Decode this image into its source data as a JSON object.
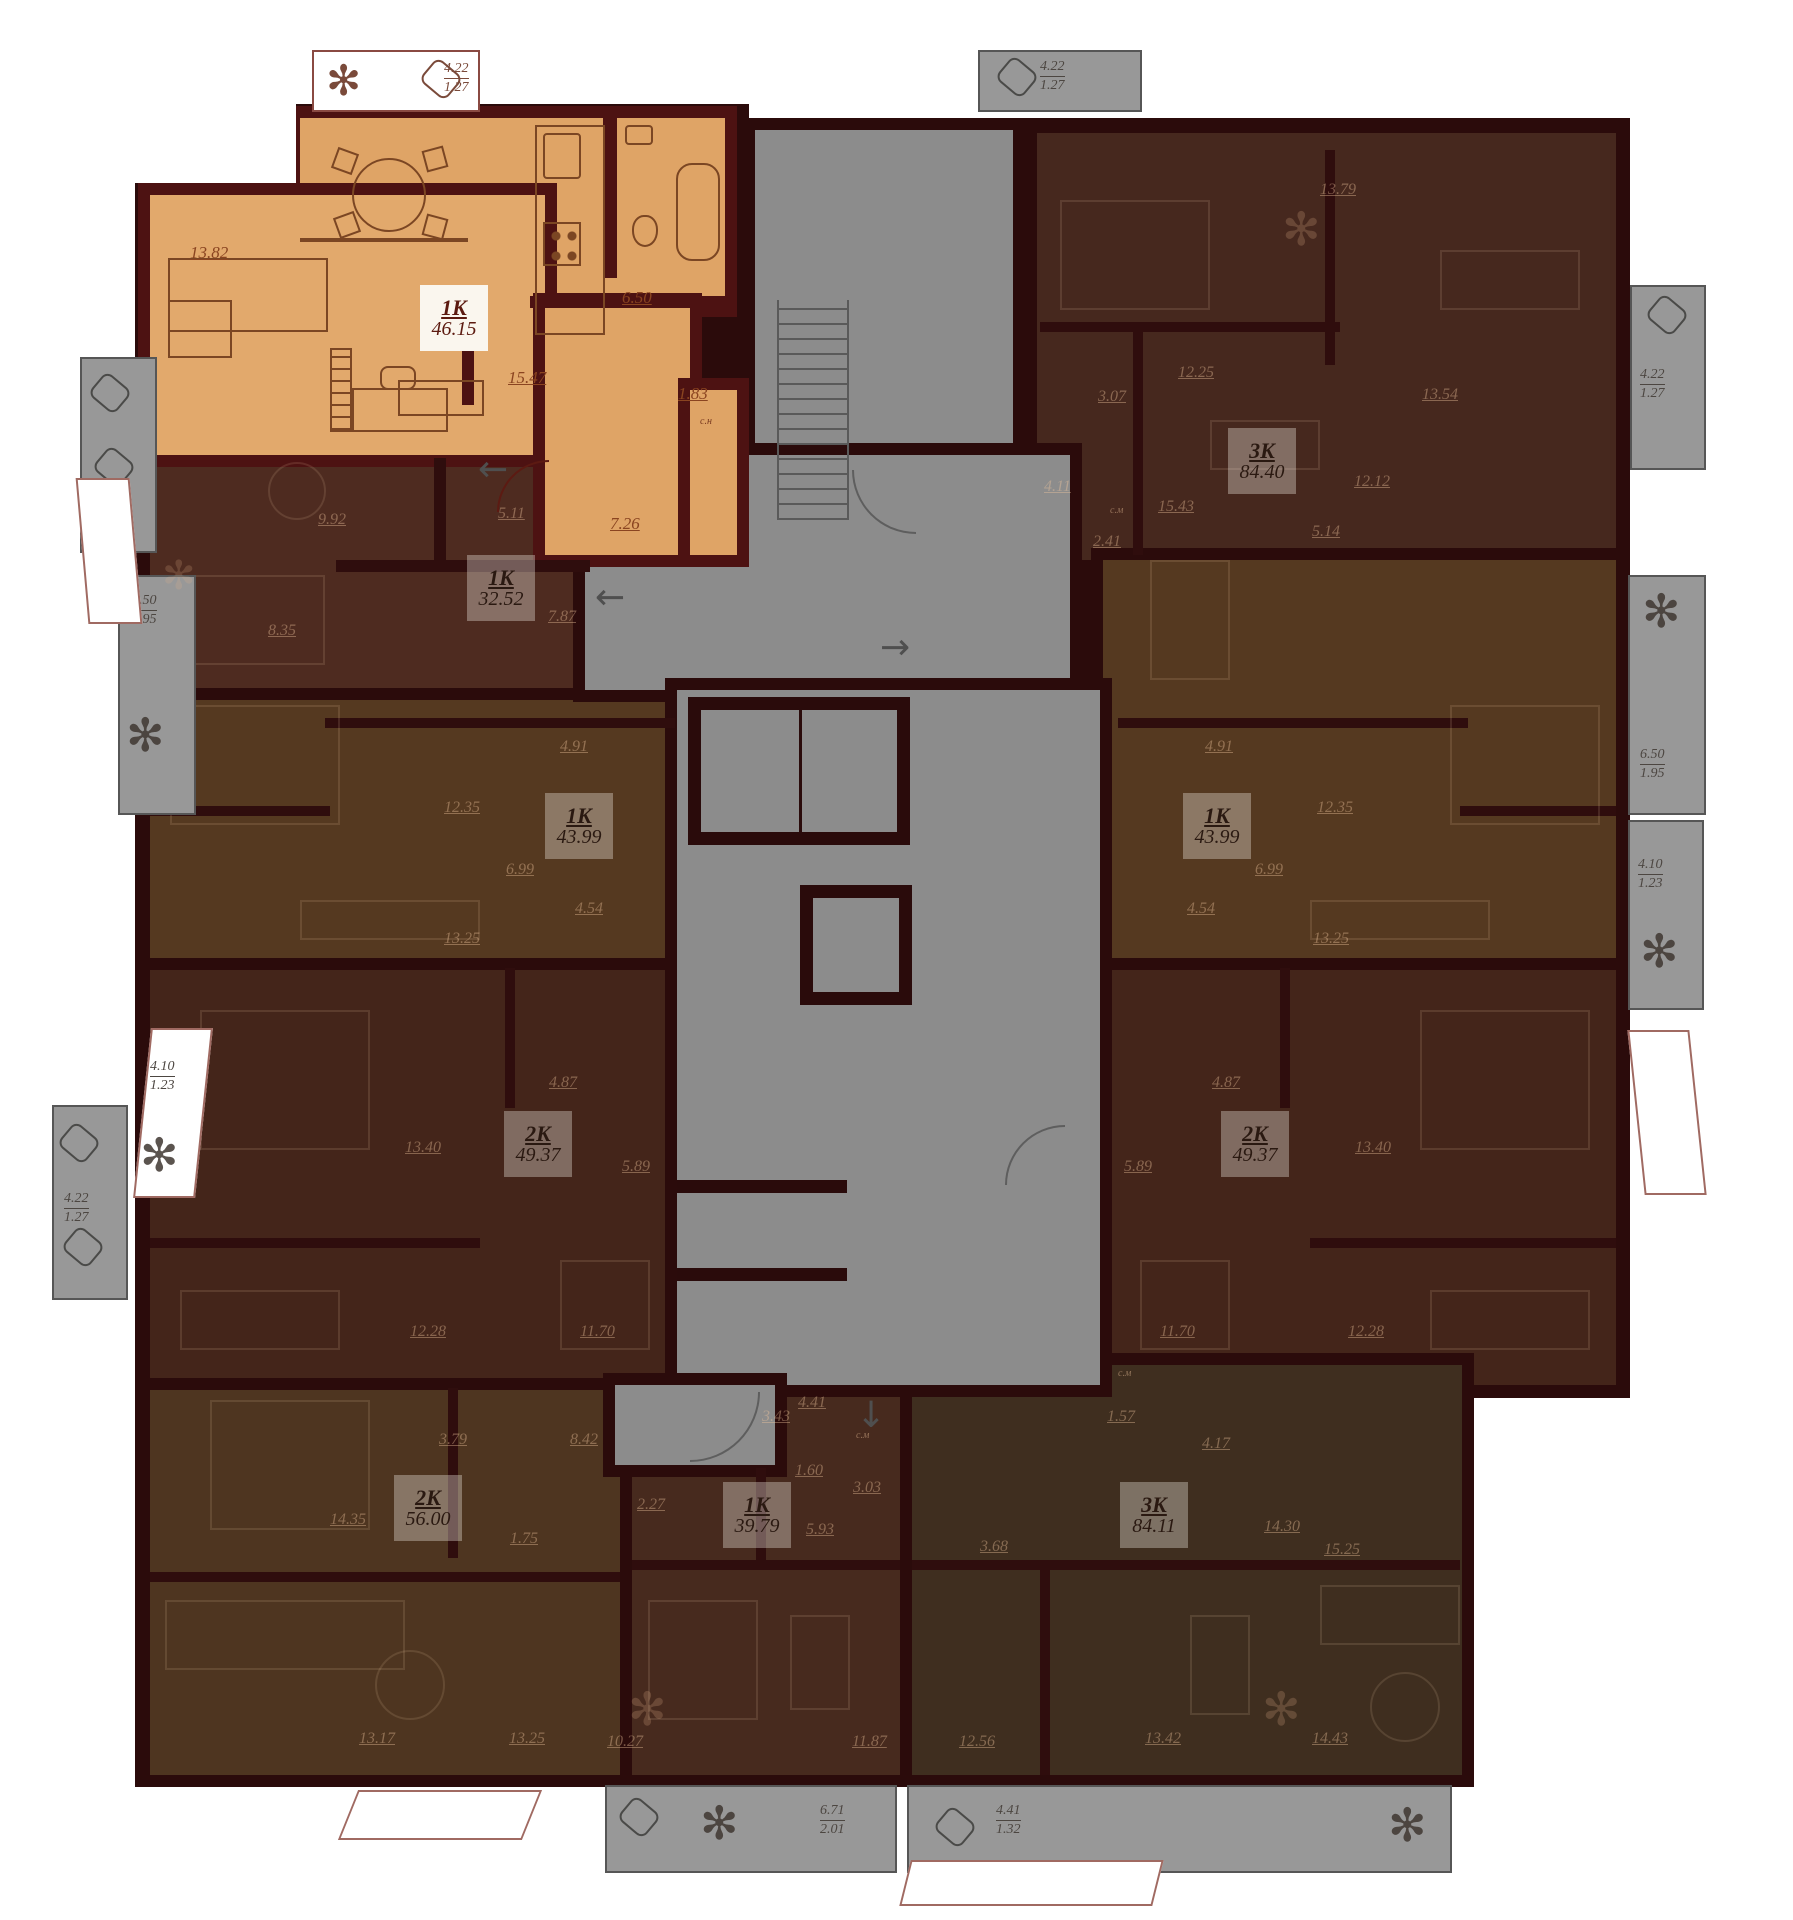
{
  "plan": {
    "title": "floor-plan",
    "units": [
      {
        "type": "1K",
        "area": "46.15",
        "dims": [
          "13.82",
          "6.50",
          "15.47",
          "1.83",
          "7.26"
        ]
      },
      {
        "type": "1K",
        "area": "32.52",
        "dims": [
          "9.92",
          "5.11",
          "7.87",
          "8.35"
        ]
      },
      {
        "type": "3K",
        "area": "84.40",
        "dims": [
          "13.79",
          "12.25",
          "3.07",
          "4.11",
          "2.41",
          "5.14",
          "12.12",
          "13.54",
          "15.43"
        ]
      },
      {
        "type": "1K",
        "area": "43.99",
        "dims": [
          "4.91",
          "12.35",
          "6.99",
          "4.54",
          "13.25"
        ]
      },
      {
        "type": "1K",
        "area": "43.99",
        "dims": [
          "4.91",
          "12.35",
          "6.99",
          "4.54",
          "13.25"
        ]
      },
      {
        "type": "2K",
        "area": "49.37",
        "dims": [
          "4.87",
          "13.40",
          "5.89",
          "12.28",
          "11.70"
        ]
      },
      {
        "type": "2K",
        "area": "49.37",
        "dims": [
          "4.87",
          "13.40",
          "5.89",
          "12.28",
          "11.70"
        ]
      },
      {
        "type": "2K",
        "area": "56.00",
        "dims": [
          "3.79",
          "8.42",
          "14.35",
          "1.75",
          "13.17",
          "13.25"
        ]
      },
      {
        "type": "1K",
        "area": "39.79",
        "dims": [
          "4.41",
          "3.43",
          "2.27",
          "3.03",
          "5.93",
          "1.60",
          "10.27",
          "11.87"
        ]
      },
      {
        "type": "3K",
        "area": "84.11",
        "dims": [
          "1.57",
          "4.17",
          "14.30",
          "15.25",
          "3.68",
          "12.56",
          "13.42",
          "14.43"
        ]
      }
    ],
    "balconies": [
      {
        "a": "4.22",
        "b": "1.27"
      },
      {
        "a": "4.22",
        "b": "1.27"
      },
      {
        "a": "4.22",
        "b": "1.27"
      },
      {
        "a": "6.50",
        "b": "1.95"
      },
      {
        "a": "4.10",
        "b": "1.23"
      },
      {
        "a": "4.22",
        "b": "1.27"
      },
      {
        "a": "4.22",
        "b": "1.27"
      },
      {
        "a": "6.50",
        "b": "1.95"
      },
      {
        "a": "4.10",
        "b": "1.23"
      },
      {
        "a": "6.71",
        "b": "2.01"
      },
      {
        "a": "4.41",
        "b": "1.32"
      }
    ],
    "storage": [
      "с.н",
      "с.м",
      "с.м",
      "с.м"
    ]
  }
}
